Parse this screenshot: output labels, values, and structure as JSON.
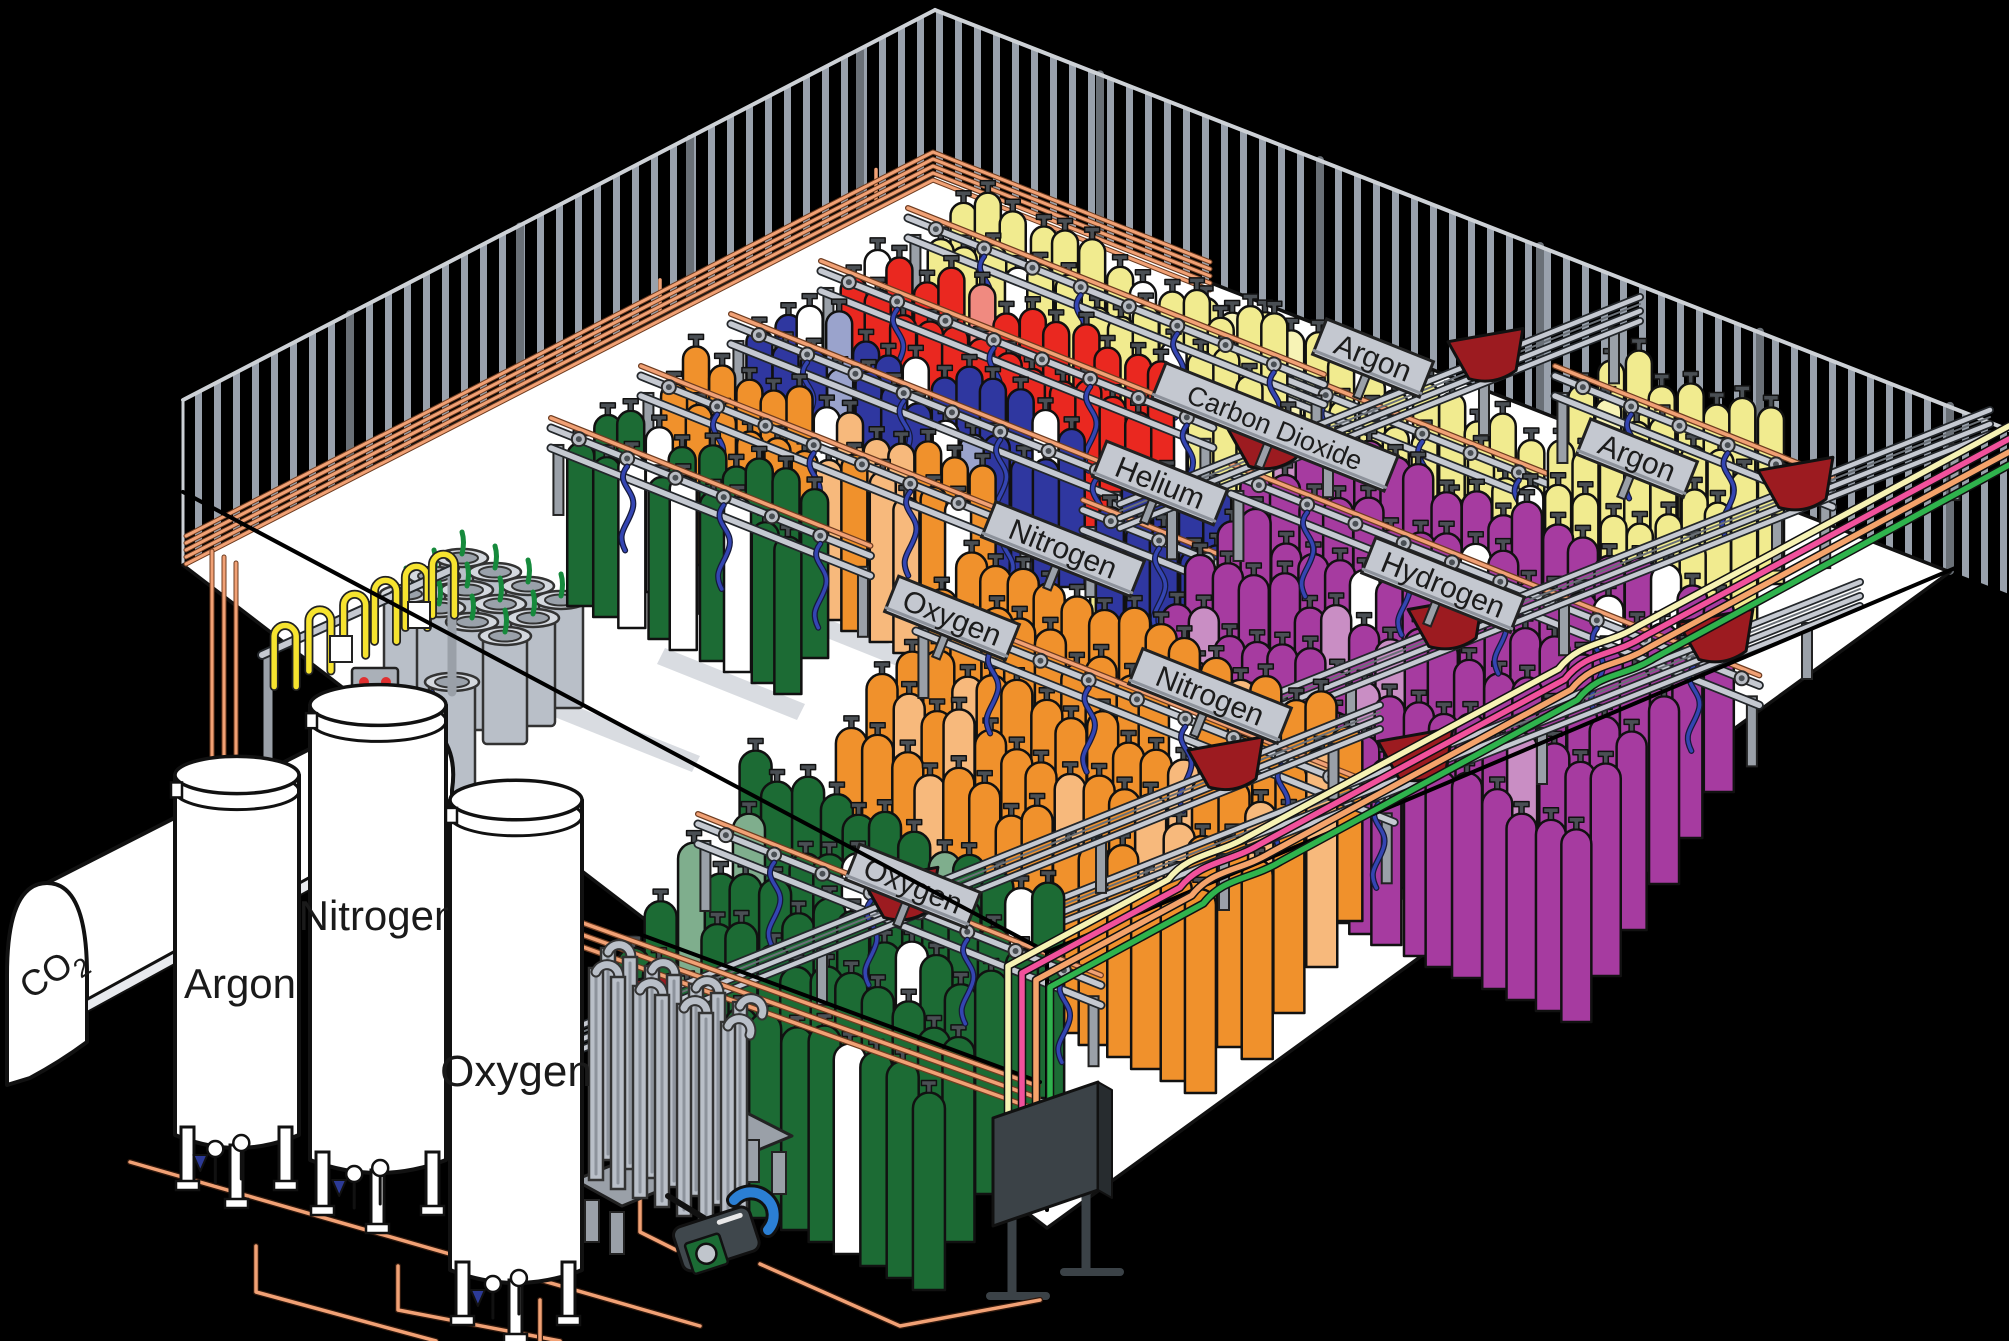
{
  "scene": {
    "type": "isometric-illustration",
    "subject": "industrial gas cylinder filling plant"
  },
  "colors": {
    "background": "#000000",
    "floor": "#ffffff",
    "outline": "#141414",
    "wall_stripe": "#99a1ac",
    "wall_edge": "#cdd1d6",
    "rail_gray": "#c5c9d1",
    "rail_dark": "#23272b",
    "sign_plate": "#c4c8d0",
    "sign_text": "#1c1c1c",
    "copper": "#f1a175",
    "copper_dark": "#6e3c20",
    "hose_blue": "#3445b2",
    "hose_yellow": "#f6e32f",
    "cart_red": "#9c1b20",
    "panel_dark": "#3b4247",
    "panel_tab": "#5a6167",
    "post_gray": "#9aa0a8",
    "dewar_gray": "#b9bfc8",
    "dewar_rim": "#d4d8de",
    "dewar_mouth": "#9aa1aa",
    "dewar_plume": "#168a3c",
    "pallet_blue": "#2c3a96",
    "tank_white": "#ffffff",
    "pump_body": "#3f474c",
    "pump_panel": "#1b6b34",
    "pump_pipe": "#2b7fd4",
    "aisle_strip": "#d9dce1",
    "cylinders": {
      "green": "#1c6b34",
      "orange": "#f0912c",
      "blue": "#2f37a0",
      "red": "#ea2820",
      "yellow": "#f1eb8f",
      "purple": "#a63ba0",
      "white": "#ffffff"
    },
    "cylinders_light": {
      "green": "#7fae8d",
      "orange": "#f7b97c",
      "blue": "#9aa3cc",
      "red": "#f08a80",
      "yellow": "#f7f3b6",
      "purple": "#c98ec4",
      "white": "#ffffff"
    },
    "supply": {
      "cream": "#f6f2b4",
      "pink": "#f1519c",
      "orange": "#f4a36b",
      "green": "#2fb34d"
    }
  },
  "storage_tanks": [
    {
      "id": "co2",
      "label": "CO2",
      "formula_main": "CO",
      "formula_sub": "2"
    },
    {
      "id": "argon",
      "label": "Argon"
    },
    {
      "id": "nitrogen",
      "label": "Nitrogen"
    },
    {
      "id": "oxygen",
      "label": "Oxygen"
    }
  ],
  "rack_signs": [
    {
      "label": "Oxygen",
      "cylinder_color": "green",
      "position": [
        913,
        886
      ]
    },
    {
      "label": "Oxygen",
      "cylinder_color": "orange",
      "position": [
        952,
        618
      ]
    },
    {
      "label": "Nitrogen",
      "cylinder_color": "blue",
      "position": [
        1063,
        549
      ]
    },
    {
      "label": "Nitrogen",
      "cylinder_color": "blue",
      "position": [
        1210,
        696
      ]
    },
    {
      "label": "Helium",
      "cylinder_color": "red",
      "position": [
        1160,
        483
      ]
    },
    {
      "label": "Carbon Dioxide",
      "cylinder_color": "yellow",
      "position": [
        1275,
        427
      ]
    },
    {
      "label": "Argon",
      "cylinder_color": "yellow",
      "position": [
        1373,
        358
      ]
    },
    {
      "label": "Hydrogen",
      "cylinder_color": "purple",
      "position": [
        1443,
        585
      ]
    },
    {
      "label": "Argon",
      "cylinder_color": "yellow",
      "position": [
        1637,
        458
      ]
    }
  ],
  "cylinder_groups": [
    {
      "name": "argon-back",
      "gas": "Argon",
      "color": "yellow",
      "origin": [
        1208,
        468
      ],
      "cols": 14,
      "rows": 5,
      "w": 26,
      "h": 168,
      "colStep": [
        27,
        11
      ],
      "rowStep": [
        -26,
        40
      ],
      "mix": {
        "light": 0.1,
        "white": 0.05
      },
      "rail": true
    },
    {
      "name": "argon-back-right",
      "gas": "Argon",
      "color": "yellow",
      "origin": [
        1610,
        518
      ],
      "cols": 7,
      "rows": 4,
      "w": 26,
      "h": 165,
      "colStep": [
        27,
        11
      ],
      "rowStep": [
        -26,
        40
      ],
      "mix": {
        "light": 0.1,
        "white": 0.05
      },
      "rail": true
    },
    {
      "name": "co2-row",
      "gas": "Carbon Dioxide",
      "color": "yellow",
      "origin": [
        963,
        360
      ],
      "cols": 13,
      "rows": 2,
      "w": 26,
      "h": 165,
      "colStep": [
        26,
        11
      ],
      "rowStep": [
        -24,
        36
      ],
      "mix": {
        "light": 0.08,
        "white": 0.2
      },
      "rail": true
    },
    {
      "name": "helium-row",
      "gas": "Helium",
      "color": "red",
      "origin": [
        876,
        413
      ],
      "cols": 12,
      "rows": 2,
      "w": 26,
      "h": 165,
      "colStep": [
        26,
        11
      ],
      "rowStep": [
        -24,
        36
      ],
      "mix": {
        "light": 0.06,
        "white": 0.22
      },
      "rail": true
    },
    {
      "name": "nitrogen-row",
      "gas": "Nitrogen",
      "color": "blue",
      "origin": [
        786,
        466
      ],
      "cols": 12,
      "rows": 2,
      "w": 26,
      "h": 165,
      "colStep": [
        26,
        11
      ],
      "rowStep": [
        -24,
        36
      ],
      "mix": {
        "light": 0.1,
        "white": 0.22
      },
      "rail": true
    },
    {
      "name": "oxygen-row",
      "gas": "Oxygen",
      "color": "orange",
      "origin": [
        696,
        518
      ],
      "cols": 12,
      "rows": 2,
      "w": 26,
      "h": 165,
      "colStep": [
        26,
        11
      ],
      "rowStep": [
        -24,
        36
      ],
      "mix": {
        "light": 0.15,
        "white": 0.2
      },
      "rail": true
    },
    {
      "name": "green-back",
      "gas": "Oxygen",
      "color": "green",
      "origin": [
        606,
        570
      ],
      "cols": 9,
      "rows": 2,
      "w": 27,
      "h": 168,
      "colStep": [
        26,
        11
      ],
      "rowStep": [
        -24,
        36
      ],
      "mix": {
        "light": 0.06,
        "white": 0.15
      },
      "rail": true
    },
    {
      "name": "nitrogen-mid",
      "gas": "Nitrogen",
      "color": "blue",
      "origin": [
        1138,
        652
      ],
      "cols": 10,
      "rows": 2,
      "w": 28,
      "h": 185,
      "colStep": [
        27,
        11
      ],
      "rowStep": [
        -26,
        40
      ],
      "mix": {
        "light": 0.1,
        "white": 0.18
      },
      "rail": true
    },
    {
      "name": "hydrogen-bank",
      "gas": "Hydrogen",
      "color": "purple",
      "origin": [
        1286,
        616
      ],
      "cols": 17,
      "rows": 6,
      "w": 30,
      "h": 200,
      "colStep": [
        27,
        11
      ],
      "rowStep": [
        -28,
        46
      ],
      "mix": {
        "light": 0.08,
        "white": 0.04
      },
      "rail": true
    },
    {
      "name": "oxygen-front-2",
      "gas": "Oxygen",
      "color": "orange",
      "origin": [
        971,
        753
      ],
      "cols": 15,
      "rows": 5,
      "w": 31,
      "h": 205,
      "colStep": [
        27,
        12
      ],
      "rowStep": [
        -30,
        46
      ],
      "mix": {
        "light": 0.15,
        "white": 0.05
      },
      "rail": true
    },
    {
      "name": "oxygen-front-1",
      "gas": "Oxygen",
      "color": "green",
      "origin": [
        753,
        966
      ],
      "cols": 12,
      "rows": 5,
      "w": 32,
      "h": 210,
      "colStep": [
        27,
        12
      ],
      "rowStep": [
        -30,
        48
      ],
      "mix": {
        "light": 0.05,
        "white": 0.06
      },
      "rail": true
    }
  ],
  "supply_lines": [
    {
      "color_key": "cream"
    },
    {
      "color_key": "pink"
    },
    {
      "color_key": "orange"
    },
    {
      "color_key": "green"
    }
  ],
  "equipment": {
    "manifold_panel_count": 6,
    "transfer_cart_count": 10,
    "dewar_count": 13,
    "vaporizer": true,
    "cryo_pump": true,
    "dewar_fill_station": true,
    "pallet": true
  }
}
